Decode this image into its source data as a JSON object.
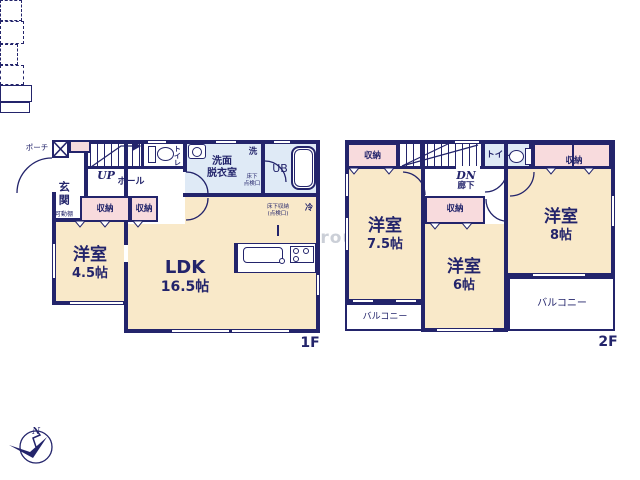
{
  "watermark": "ME Group",
  "compass_label": "N",
  "colors": {
    "wall_navy": "#23246b",
    "room_cream": "#f9e9c9",
    "closet_pink": "#f8dbdd",
    "wet_room_blue": "#dfeaf6",
    "watermark_gray": "#c2c7d1"
  },
  "floor1": {
    "label": "1F",
    "porch": "ポーチ",
    "entrance": "玄関",
    "entrance_shelf": "可動棚",
    "stairs": "UP",
    "hall": "ホール",
    "toilet": "トイレ",
    "washroom": [
      "洗面",
      "脱衣室"
    ],
    "laundry": "洗",
    "underfloor_hatch": [
      "床下",
      "点検口"
    ],
    "unit_bath": "UB",
    "closet_a": "収納",
    "closet_b": "収納",
    "fridge": "冷",
    "underfloor_storage": [
      "床下収納",
      "(点検口)"
    ],
    "western_room": {
      "name": "洋室",
      "size": "4.5帖"
    },
    "ldk": {
      "name": "LDK",
      "size": "16.5帖"
    }
  },
  "floor2": {
    "label": "2F",
    "stairs": "DN",
    "corridor": "廊下",
    "toilet": "トイレ",
    "closet_left": "収納",
    "closet_right": "収納",
    "closet_middle": "収納",
    "room_75": {
      "name": "洋室",
      "size": "7.5帖"
    },
    "room_6": {
      "name": "洋室",
      "size": "6帖"
    },
    "room_8": {
      "name": "洋室",
      "size": "8帖"
    },
    "balcony_left": "バルコニー",
    "balcony_right": "バルコニー"
  }
}
